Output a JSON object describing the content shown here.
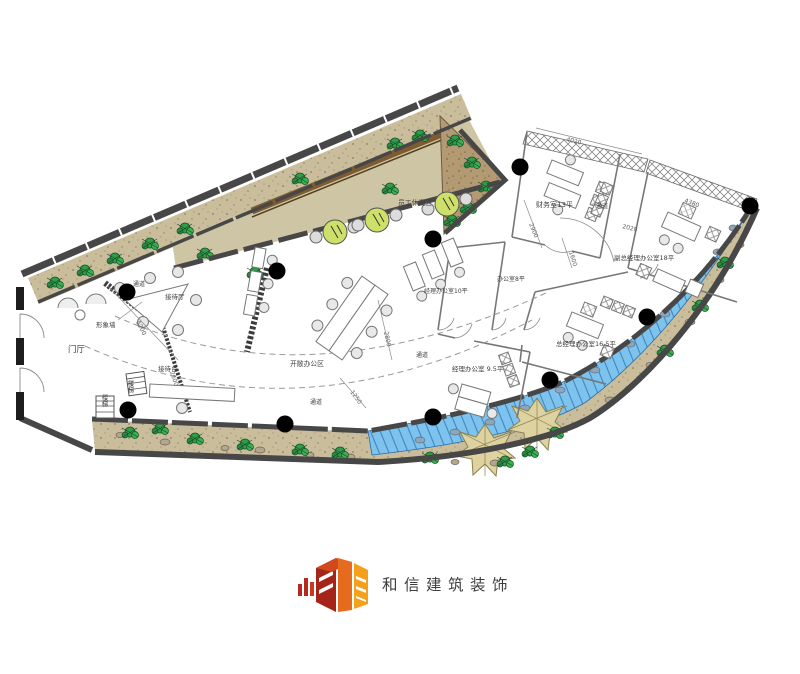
{
  "page": {
    "background": "#ffffff"
  },
  "logo": {
    "company_name": "和信建筑装饰",
    "colors": {
      "red": "#a6251a",
      "mid_red": "#d2491d",
      "orange": "#f5a01d",
      "text": "#54575b"
    }
  },
  "plan": {
    "area_labels": {
      "foyer": "门厅",
      "feature_wall": "形象墙",
      "reception_hall": "接待厅",
      "reception_desk": "接待台",
      "stairs": "楼梯",
      "passage": "通道",
      "open_office": "开敞办公区",
      "staff_lounge": "员工休闲区",
      "finance_office": "财务室13平",
      "deputy_gm_office": "副总经理办公室18平",
      "gm_office": "总经理办公室16.5平",
      "manager_office_9_5": "经理办公室 9.5平",
      "manager_office_10": "经理办公室10平",
      "office_8": "办公室8平"
    },
    "dimensions": [
      "5200",
      "2600",
      "2800",
      "1250",
      "2900",
      "4020",
      "4380",
      "1600",
      "2020"
    ],
    "colors": {
      "wall": "#474747",
      "landscape": "#c9bd9b",
      "planter": "#b49a73",
      "lounge_floor": "#cec5a4",
      "water": "#7ec3ee",
      "canopy": "#ded3a0",
      "plant": "#2f9e44",
      "lounge_table": "#cfe06a"
    }
  }
}
